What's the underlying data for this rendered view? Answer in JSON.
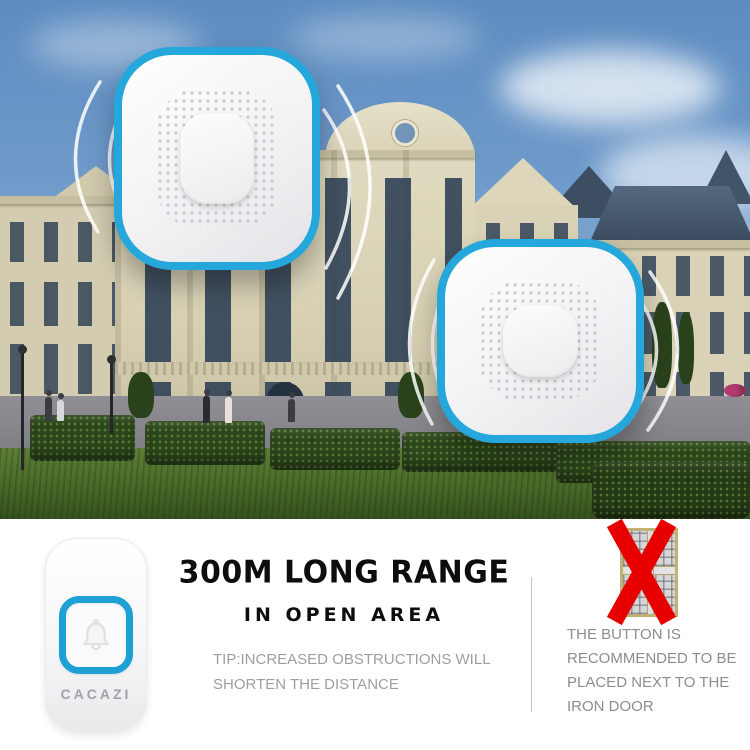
{
  "brand": {
    "name": "CACAZI"
  },
  "headline": {
    "title": "300M LONG RANGE",
    "subtitle": "IN OPEN AREA"
  },
  "tip": {
    "line1": "TIP:INCREASED OBSTRUCTIONS WILL",
    "line2": "SHORTEN THE DISTANCE"
  },
  "warning": {
    "lines": [
      "THE BUTTON IS",
      "RECOMMENDED TO BE",
      "PLACED NEXT TO THE",
      "IRON DOOR"
    ]
  },
  "colors": {
    "accent_blue": "#1fa0d4",
    "warning_red": "#e60000",
    "heading_black": "#0d0d0d",
    "muted_gray": "#9e9e9e"
  },
  "icons": {
    "bell": "bell-outline",
    "signal_waves": "wireless-arcs",
    "red_x": "crossed-out"
  },
  "scene": {
    "receivers_count": 2,
    "subject": "wireless doorbell receivers on mansion backdrop"
  }
}
